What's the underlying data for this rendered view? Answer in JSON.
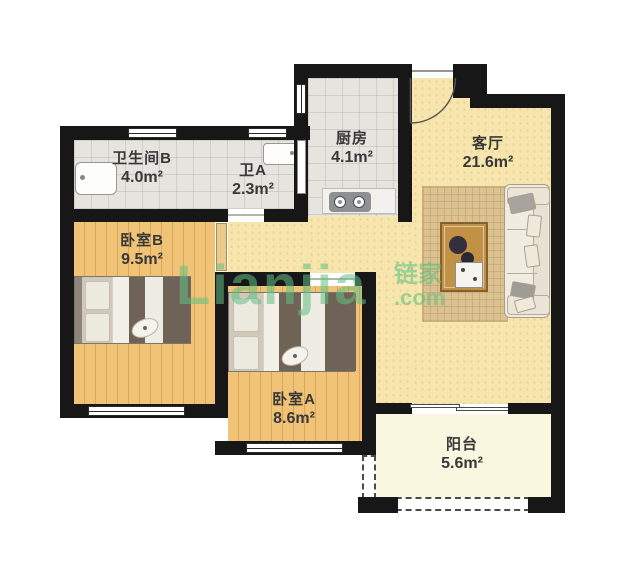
{
  "meta": {
    "content_type": "residential floor plan"
  },
  "watermark": {
    "brand": "Lianjia",
    "brand_cn": "链家",
    "domain_suffix": ".com",
    "color": "#60c084"
  },
  "rooms": [
    {
      "id": "bathroom-b",
      "name": "卫生间B",
      "area": "4.0m²"
    },
    {
      "id": "bathroom-a",
      "name": "卫A",
      "area": "2.3m²"
    },
    {
      "id": "kitchen",
      "name": "厨房",
      "area": "4.1m²"
    },
    {
      "id": "living-room",
      "name": "客厅",
      "area": "21.6m²"
    },
    {
      "id": "bedroom-b",
      "name": "卧室B",
      "area": "9.5m²"
    },
    {
      "id": "bedroom-a",
      "name": "卧室A",
      "area": "8.6m²"
    },
    {
      "id": "balcony",
      "name": "阳台",
      "area": "5.6m²"
    }
  ],
  "furniture": [
    "double-bed-bedroom-b",
    "double-bed-bedroom-a",
    "sofa",
    "coffee-table",
    "rug",
    "gas-stove",
    "bathtub",
    "washbasin",
    "entry-door-arc"
  ],
  "colors": {
    "wall": "#171717",
    "tile_floor": "#e6e4df",
    "living_floor": "#f7e5ae",
    "wood_floor": "#f0c376",
    "balcony_floor": "#faf7e1",
    "label_text": "#383838"
  }
}
